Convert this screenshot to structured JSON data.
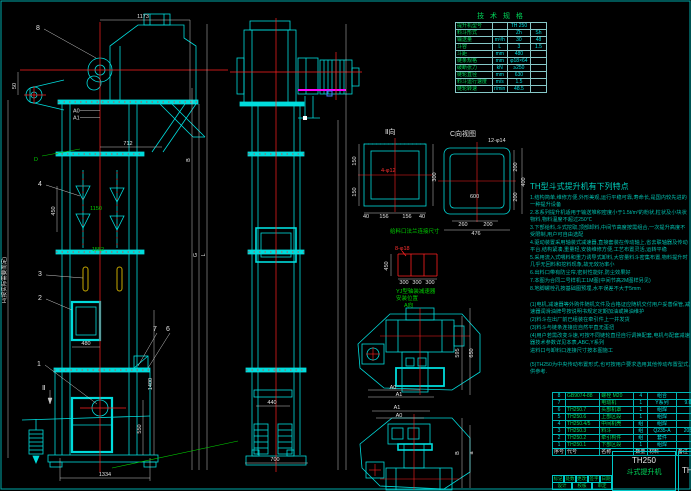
{
  "colors": {
    "background": "#000000",
    "geometry_cyan": "#00dcdc",
    "centerline_red": "#ff2020",
    "dimension_white": "#e0e0e0",
    "annotation_green": "#00d000",
    "notes_teal": "#00bfae",
    "accent_magenta": "#ff00ff",
    "bucket_yellow": "#c8aa00"
  },
  "labels": {
    "d1173": "1173",
    "d712": "712",
    "d50": "50",
    "a0": "A0",
    "a1": "A1",
    "b8": "8",
    "b4": "4",
    "b3": "3",
    "b2": "2",
    "b1": "1",
    "b7": "7",
    "b6": "6",
    "dD": "D",
    "dII": "Ⅱ",
    "d450": "450",
    "g1150": "1150",
    "g1552": "1552",
    "d480": "480",
    "d550": "550",
    "d1400": "1400",
    "d1334": "1334",
    "hNote": "H(按实际需要而定)",
    "dG": "G",
    "dL": "L",
    "dB": "B",
    "s440": "440",
    "s700": "700",
    "i_title": "Ⅱ向",
    "i_300": "300",
    "i_150a": "150",
    "i_150b": "150",
    "i_40a": "40",
    "i_156a": "156",
    "i_156b": "156",
    "i_40b": "40",
    "i_hole": "4-φ12",
    "c_title": "C向视图",
    "c_hole": "12-φ14",
    "c_600": "600",
    "c_260": "260",
    "c_200": "200",
    "c_476": "476",
    "c_200a": "200",
    "c_200b": "200",
    "c_400": "400",
    "f_title": "给料口法兰连接尺寸",
    "f_hole": "8-φ18",
    "f_450": "450",
    "f_300a": "300",
    "f_300b": "300",
    "f_300c": "300",
    "f_note1": "YJ型轴装减速器",
    "f_note2": "安装位置",
    "t1_title": "A向",
    "t1_a0": "A0",
    "t1_a1": "A1",
    "t1_595": "595",
    "t1_650": "650",
    "t2_a1": "A1",
    "t2_a0": "A0",
    "t2_B": "B",
    "t2_a": "a"
  },
  "spec_table": {
    "title": "技 术 规 格",
    "rows": [
      [
        "提升机型号",
        "",
        "TH 250",
        ""
      ],
      [
        "料斗形式",
        "",
        "Zh",
        "Sh"
      ],
      [
        "输送量",
        "m³/h",
        "30",
        "48"
      ],
      [
        "斗容",
        "L",
        "3",
        "1.5"
      ],
      [
        "斗距",
        "mm",
        "480",
        ""
      ],
      [
        "链条规格",
        "mm",
        "φ18×64",
        ""
      ],
      [
        "破断张力",
        "kN",
        "≥250",
        ""
      ],
      [
        "链轮直径",
        "mm",
        "630",
        ""
      ],
      [
        "料斗运行速度",
        "m/s",
        "1.5",
        ""
      ],
      [
        "链轮转速",
        "r/min",
        "48.5",
        ""
      ]
    ]
  },
  "notes": {
    "title": "TH型斗式提升机有下列特点",
    "lines": [
      "1.结构简单,维修方便,外形美观,运行平稳可靠,寿命长,是国内较先进的一种提升设备",
      "2.本系列提升机适用于输送堆积密度小于1.5t/m³的粉状,粒状及小块状物料,物料温度不超过250℃",
      "3.下部给料,斗式挖取,顶部卸料,中间节高度按需组合,一次提升高度不受限制,用户可自由选配",
      "4.驱动装置采用轴装式减速器,直接套装在传动轴上,省去联轴器及传动平台,结构紧凑,重量轻,安装维修方便,工艺布置灵活,运转平稳",
      "5.采用流入式喂料和重力诱导式卸料,大容量料斗密集布置,物料提升时几乎无回料和挖料现象,故无效功率小",
      "6.出料口带有防尘帘,密封性能好,防尘效果好",
      "7.本图为合同二号样机工1M图(中间节高2M图样另见)",
      "8.地脚螺栓孔按基础图预埋,水平误差不大于5mm",
      "(1)电机,减速器等外购件随机文件及合格证应随机交付用户妥善保管,减速器润滑油牌号按说明书规定定期加油或换油维护",
      "(2)料斗在出厂前已组装在牵引件上一并发货",
      "(3)料斗与链条连接应自然平直无歪扭",
      "(4)用户若需改变斗速,可按不同链轮直径自行调换配套,电机与配套减速器技术参数详见本表,ABC,Y系列",
      "进料口与卸料口连接尺寸按本图施工",
      "(5)TH250为中央传动布置形式,也可按用户要求选用其他传动布置型式,供参考."
    ]
  },
  "bom": {
    "header": [
      "序号",
      "代号",
      "名称",
      "数量",
      "材料",
      "备注"
    ],
    "rows": [
      [
        "8",
        "GB9074-88",
        "螺栓 M20",
        "4",
        "组合",
        ""
      ],
      [
        "7",
        "",
        "电动机",
        "1",
        "Y系列",
        "9.0"
      ],
      [
        "6",
        "TH250.7",
        "头部机罩",
        "1",
        "组焊",
        ""
      ],
      [
        "5",
        "TH250.6",
        "上部区段",
        "1",
        "组焊",
        ""
      ],
      [
        "4",
        "TH250.4/5",
        "中间机壳",
        "组",
        "组焊",
        ""
      ],
      [
        "3",
        "TH250.3",
        "料斗",
        "组",
        "Q235-A",
        "205"
      ],
      [
        "2",
        "TH250.2",
        "牵引构件",
        "组",
        "套件",
        ""
      ],
      [
        "1",
        "TH250.1",
        "下部区段",
        "1",
        "组焊",
        ""
      ]
    ]
  },
  "title_block": {
    "model": "TH250",
    "name": "斗式提升机",
    "right_partial": "TH2",
    "fields": [
      "标记",
      "处数",
      "更改文件号",
      "签字",
      "日期"
    ],
    "fields2": [
      "设计",
      "校核",
      "审定"
    ]
  }
}
